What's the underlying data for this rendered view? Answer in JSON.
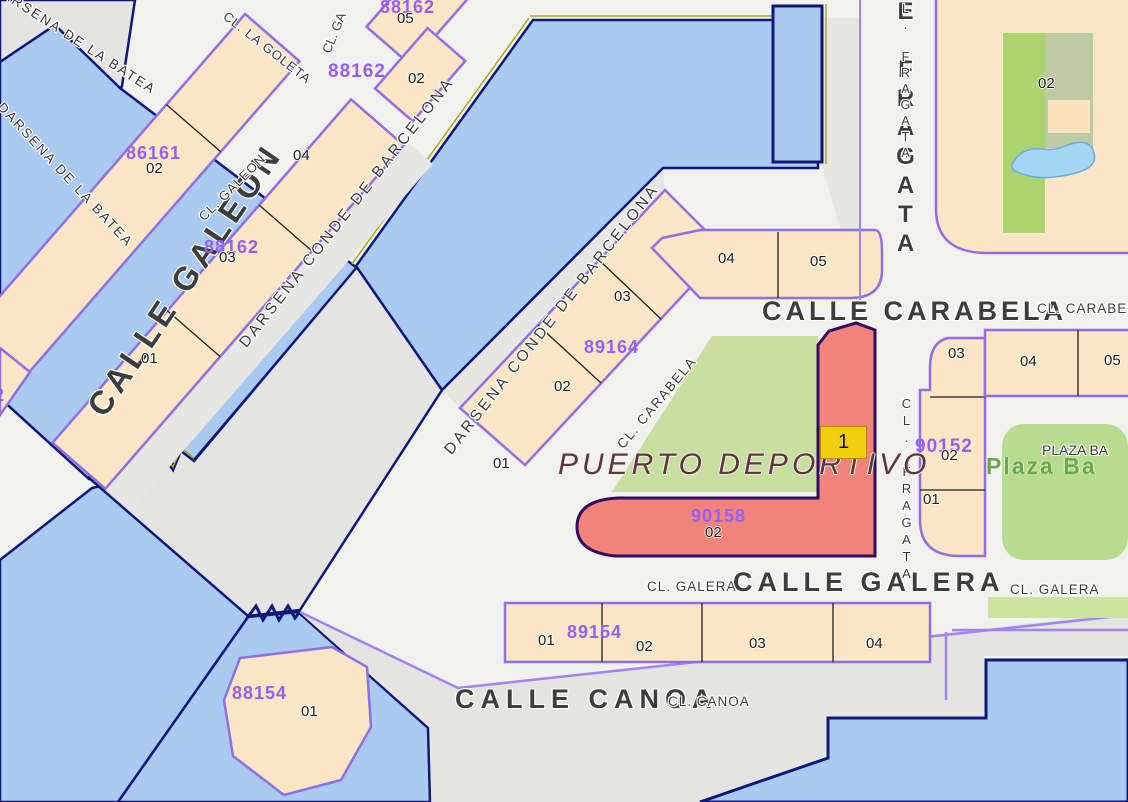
{
  "streets": {
    "darsena_batea_1": "DARSENA DE LA BATEA",
    "darsena_batea_2": "DARSENA DE LA BATEA",
    "cl_la_goleta": "CL. LA GOLETA",
    "cl_g_partial": "CL. GA",
    "calle_galeon_big": "CALLE GALEON",
    "cl_galeon": "CL. GALEON",
    "darsena_conde_1": "DARSENA CONDE DE BARCELONA",
    "darsena_conde_2": "DARSENA CONDE DE BARCELONA",
    "cl_carabela_diag": "CL. CARABELA",
    "calle_carabela_big": "CALLE CARABELA",
    "cl_carabela_right": "CL. CARABELA",
    "calle_fragata_big": "CALLE FRAGATA",
    "cl_fragata_top": "CL. FRAGATA",
    "cl_fragata_mid": "CL. FRAGATA",
    "calle_galera_big": "CALLE GALERA",
    "cl_galera_left": "CL. GALERA",
    "cl_galera_right": "CL. GALERA",
    "calle_canoa_big": "CALLE CANOA",
    "cl_canoa": "CL. CANOA",
    "puerto_deportivo": "PUERTO DEPORTIVO",
    "plaza_black": "PLAZA BA",
    "plaza_green": "Plaza Ba"
  },
  "cadastral_codes": {
    "c_88162_top": "88162",
    "c_88162_goleta": "88162",
    "c_86161": "86161",
    "c_88162_galeon": "88162",
    "c_89164": "89164",
    "c_90158": "90158",
    "c_90152": "90152",
    "c_89154": "89154",
    "c_88154": "88154",
    "c_edge_fragment": "2"
  },
  "parcel_numbers": {
    "goleta_05": "05",
    "goleta_02": "02",
    "galeon_04": "04",
    "galeon_02": "02",
    "galeon_03": "03",
    "galeon_01": "01",
    "conde_01": "01",
    "conde_02": "02",
    "conde_03": "03",
    "conde_04": "04",
    "conde_05": "05",
    "fragata_03": "03",
    "fragata_04": "04",
    "fragata_05": "05",
    "fragata_02": "02",
    "fragata_01": "01",
    "tr_block_02": "02",
    "galera_01": "01",
    "galera_02": "02",
    "galera_03": "03",
    "galera_04": "04",
    "deportivo_02": "02",
    "canoa_01": "01"
  },
  "highlight": {
    "badge": "1"
  },
  "colors": {
    "water": "#A9CBF1",
    "coastline": "#0D1878",
    "land": "#F1F1EF",
    "dock": "#E4E4E2",
    "parcel_fill": "#FAE5C5",
    "parcel_border": "#8F6FE3",
    "code_text": "#9560F2",
    "highlight_fill": "#F2837B",
    "highlight_border": "#2E0D62",
    "badge_bg": "#F2CF0E",
    "park_green": "#C7E0A2",
    "plaza_green": "#B7DC90",
    "pond_blue": "#A5D7F5",
    "olive_accent": "#A8A818",
    "green_text": "#6BA74D"
  }
}
